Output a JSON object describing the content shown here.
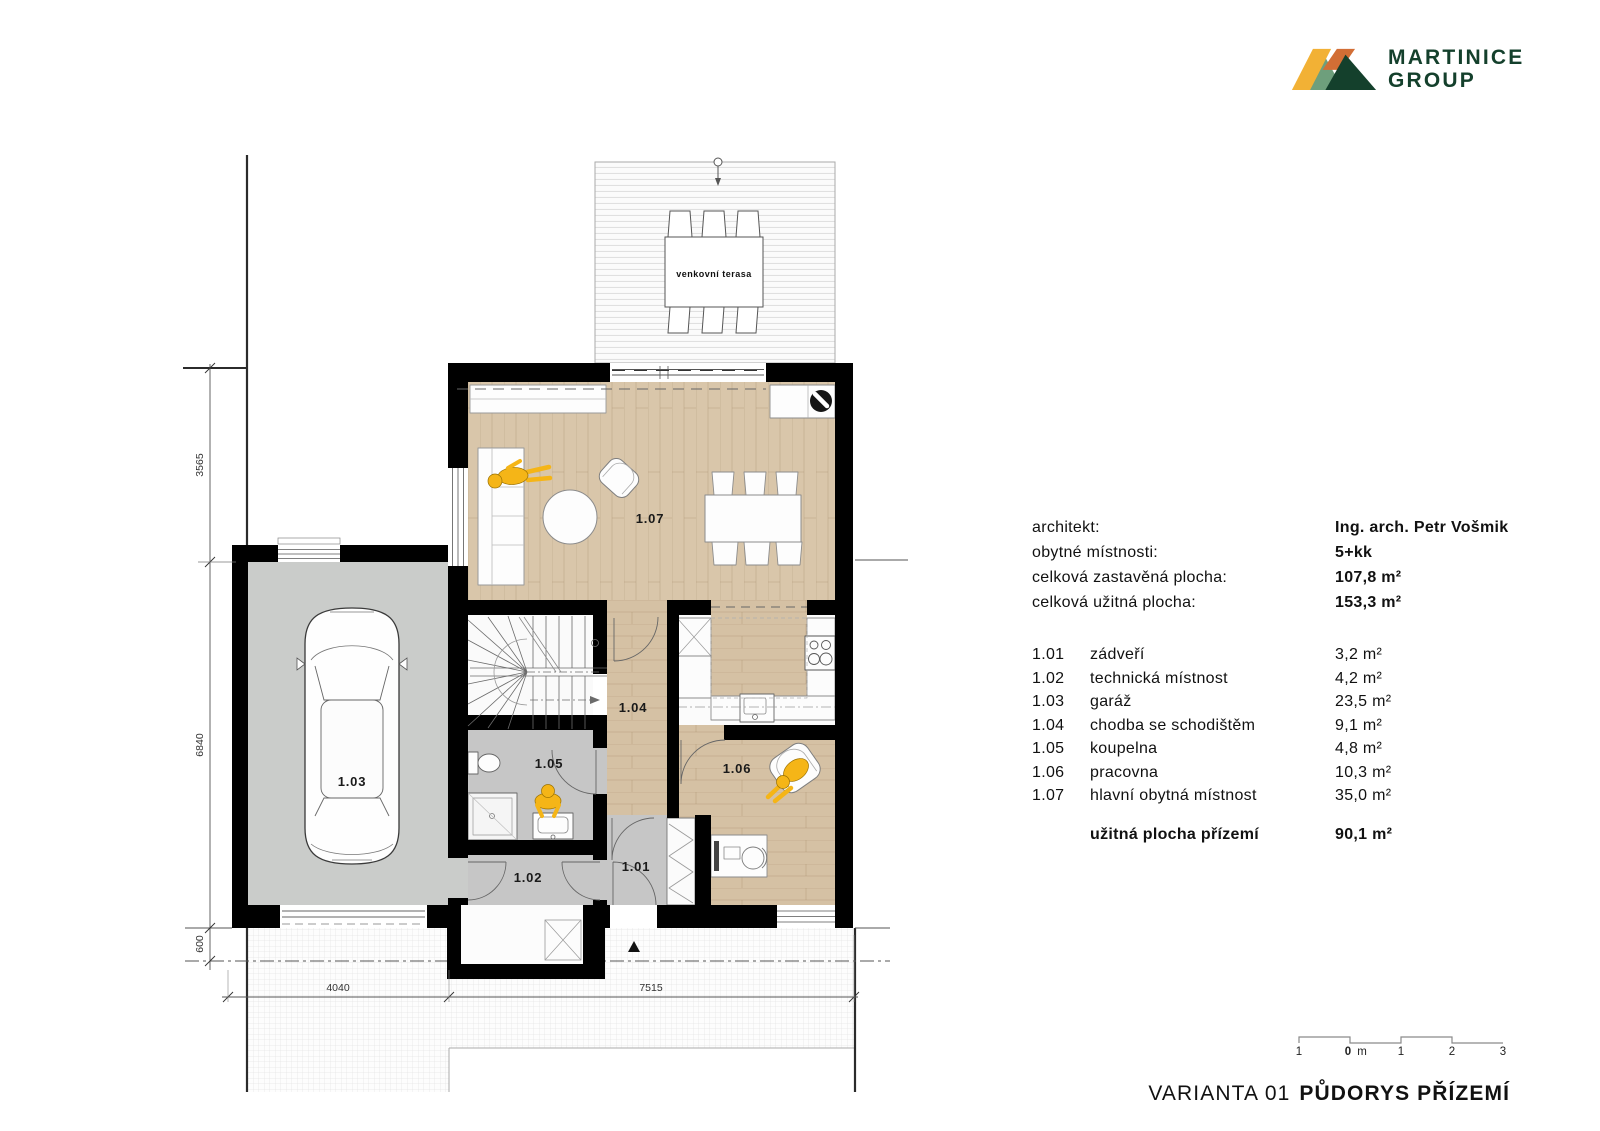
{
  "logo": {
    "line1": "MARTINICE",
    "line2": "GROUP"
  },
  "colors": {
    "brand_green": "#14402C",
    "logo_yellow": "#F2B135",
    "logo_orange": "#D26E35",
    "logo_lightgreen": "#6E9F7C",
    "wall": "#000000",
    "wood_floor": "#D9C6AA",
    "gray_floor": "#C6C6C6",
    "person_yellow": "#F5B517"
  },
  "info": {
    "rows": [
      {
        "label": "architekt:",
        "value": "Ing. arch. Petr Vošmik"
      },
      {
        "label": "obytné místnosti:",
        "value": "5+kk"
      },
      {
        "label": "celková zastavěná plocha:",
        "value": "107,8 m²"
      },
      {
        "label": "celková užitná plocha:",
        "value": "153,3 m²"
      }
    ]
  },
  "rooms": {
    "rows": [
      {
        "no": "1.01",
        "name": "zádveří",
        "area": "3,2 m²"
      },
      {
        "no": "1.02",
        "name": "technická místnost",
        "area": "4,2 m²"
      },
      {
        "no": "1.03",
        "name": "garáž",
        "area": "23,5 m²"
      },
      {
        "no": "1.04",
        "name": "chodba se schodištěm",
        "area": "9,1 m²"
      },
      {
        "no": "1.05",
        "name": "koupelna",
        "area": "4,8 m²"
      },
      {
        "no": "1.06",
        "name": "pracovna",
        "area": "10,3 m²"
      },
      {
        "no": "1.07",
        "name": "hlavní obytná místnost",
        "area": "35,0 m²"
      }
    ],
    "summary": {
      "label": "užitná plocha přízemí",
      "value": "90,1 m²"
    }
  },
  "plan": {
    "labels": {
      "terrace": "venkovní terasa",
      "living": "1.07",
      "corridor": "1.04",
      "bath": "1.05",
      "office": "1.06",
      "entry": "1.01",
      "utility": "1.02",
      "garage": "1.03"
    },
    "dimensions": {
      "left_top": "3565",
      "left_mid": "6840",
      "left_bottom": "600",
      "bottom_left": "4040",
      "bottom_right": "7515"
    }
  },
  "scalebar": {
    "labels": [
      "1",
      "0",
      "m",
      "1",
      "2",
      "3"
    ]
  },
  "title": {
    "variant": "VARIANTA 01",
    "name": "PŮDORYS PŘÍZEMÍ"
  }
}
